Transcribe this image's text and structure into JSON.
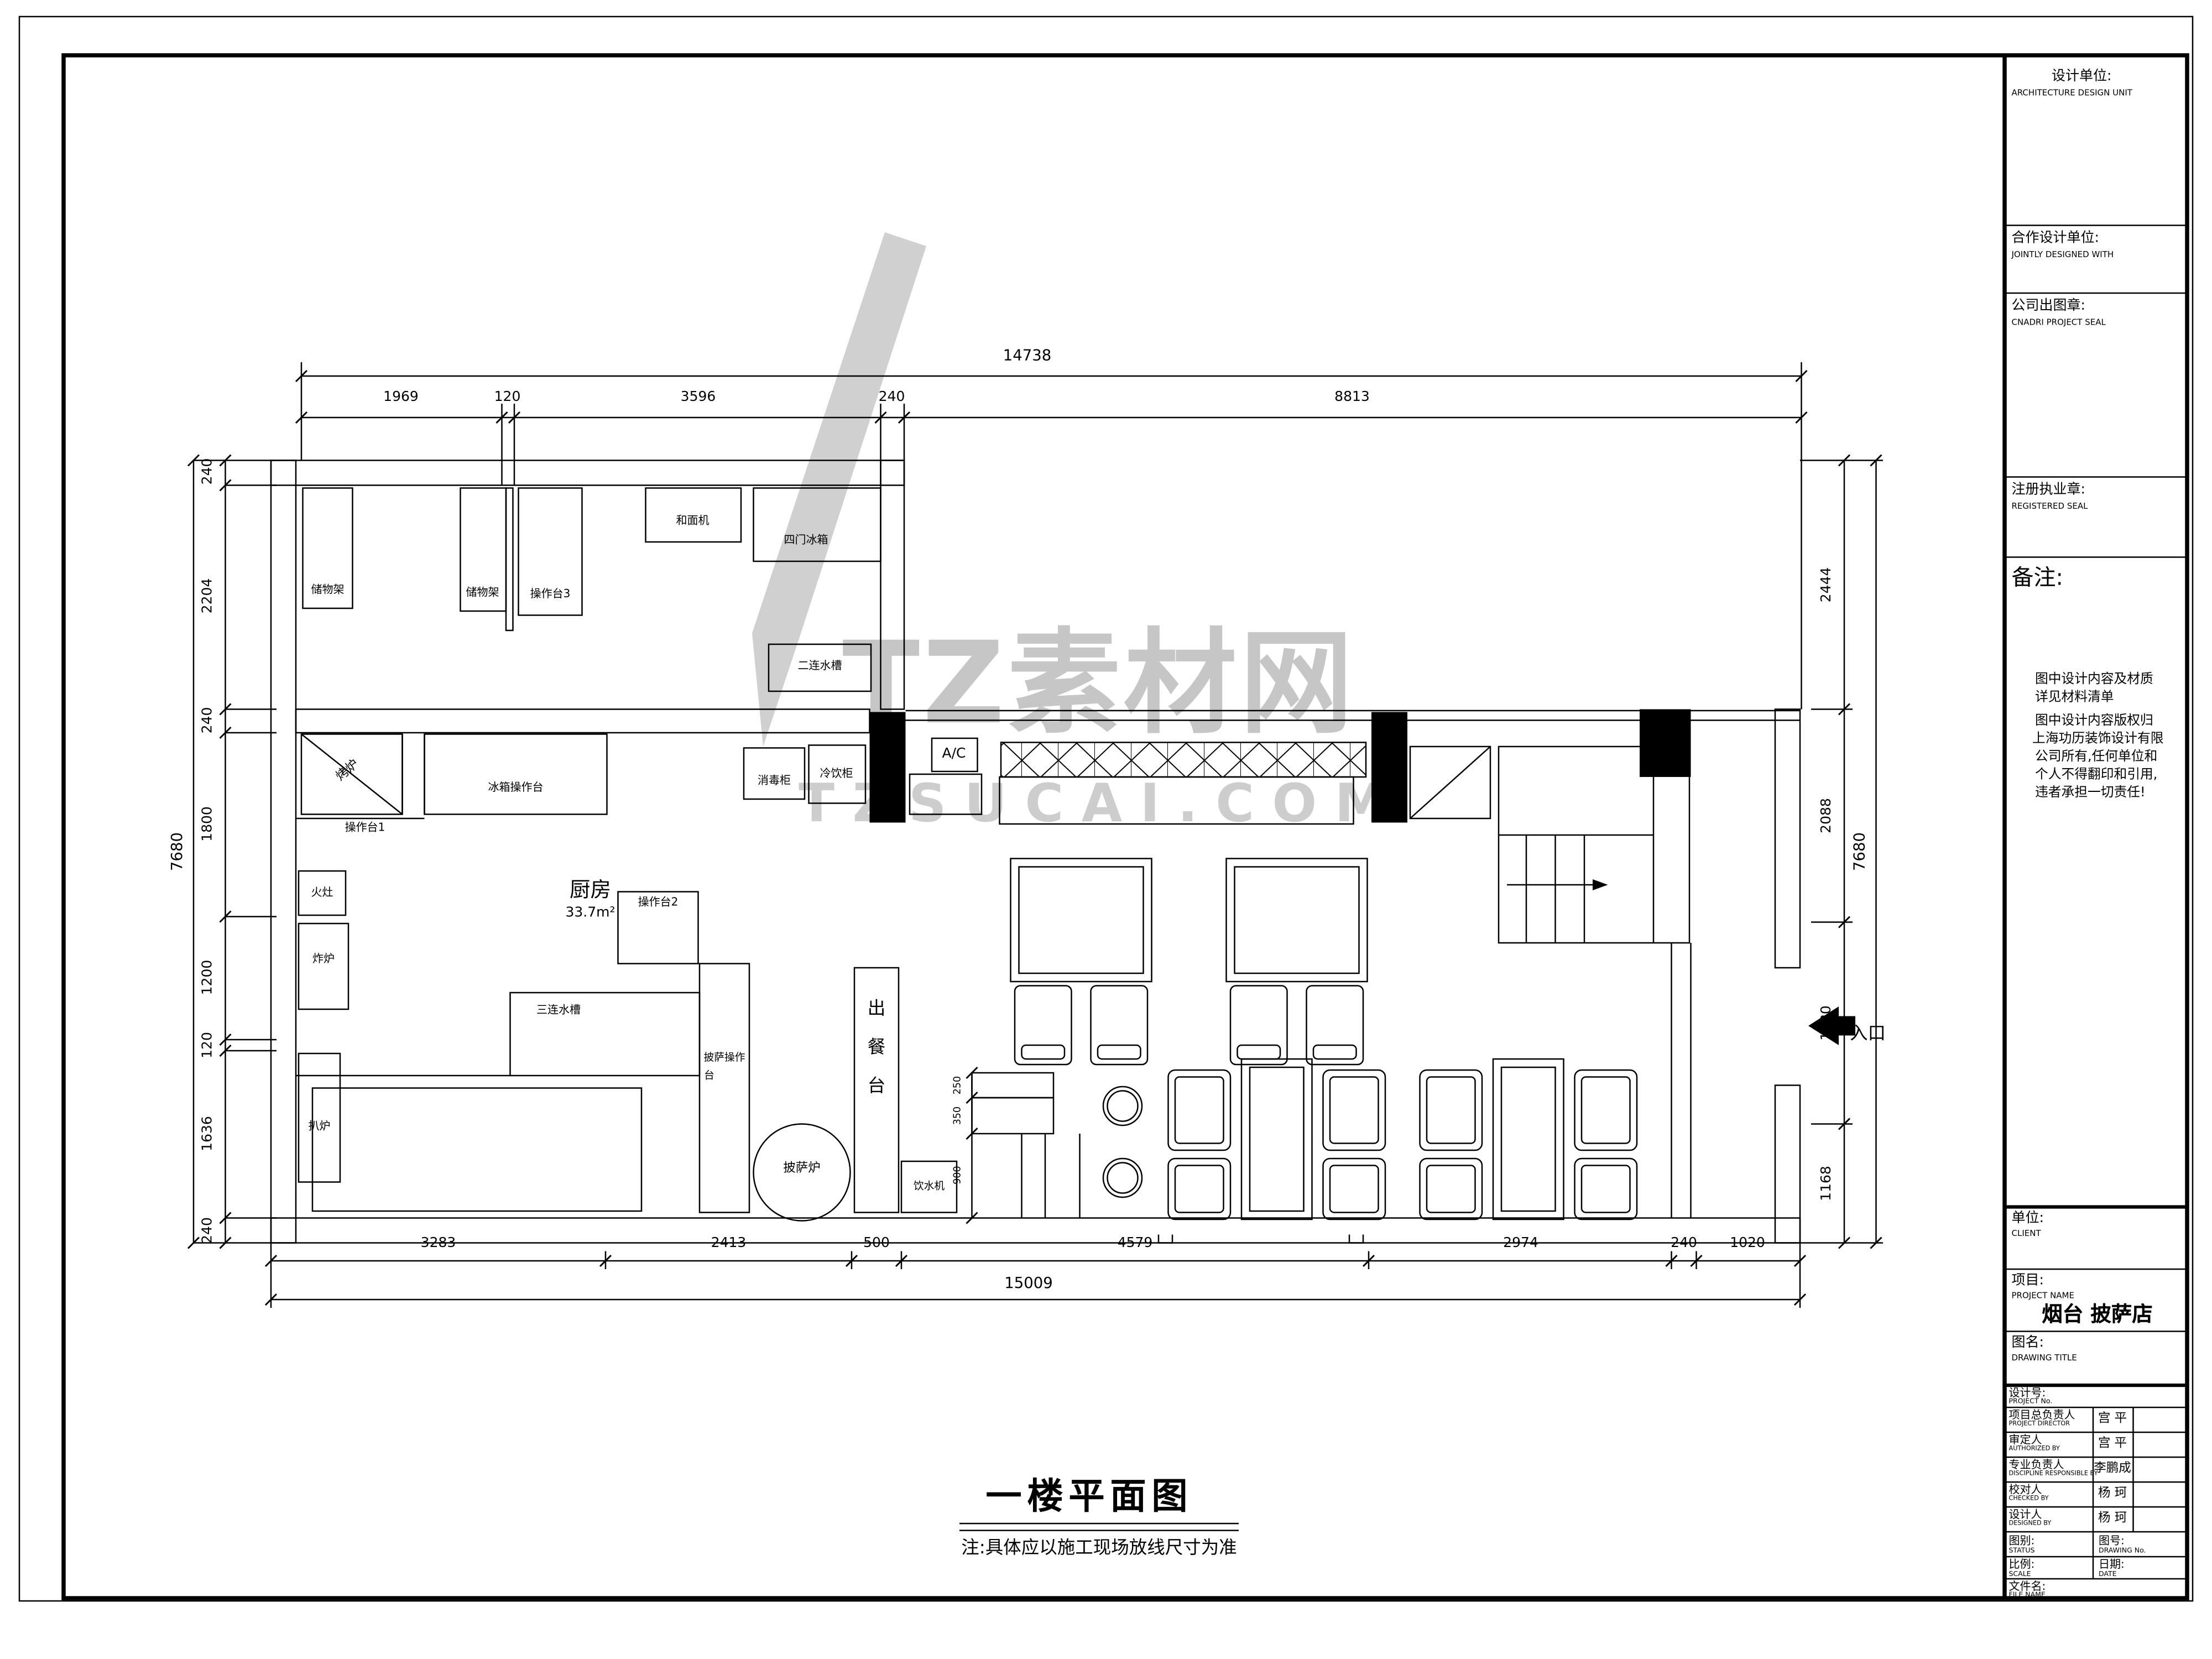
{
  "watermark": {
    "brand": "TZ素材网",
    "domain": "TZSUCAI.COM"
  },
  "dims": {
    "top": {
      "total": "14738",
      "segments": [
        "1969",
        "120",
        "3596",
        "240",
        "8813"
      ]
    },
    "bottom": {
      "total": "15009",
      "segments": [
        "3283",
        "2413",
        "500",
        "4579",
        "2974",
        "240",
        "1020"
      ]
    },
    "left": {
      "total": "7680",
      "segments": [
        "240",
        "2204",
        "240",
        "1800",
        "1200",
        "120",
        "1636",
        "240"
      ]
    },
    "right": {
      "total": "7680",
      "segments": [
        "2444",
        "2088",
        "1980",
        "1168"
      ]
    },
    "service_counter": [
      "250",
      "350",
      "900"
    ]
  },
  "plan": {
    "entrance": "入口",
    "room": {
      "name": "厨房",
      "area": "33.7m²"
    },
    "equipment": {
      "shelf1": "储物架",
      "shelf2": "储物架",
      "worktop3": "操作台3",
      "dough_mixer": "和面机",
      "four_door_fridge": "四门冰箱",
      "double_sink": "二连水槽",
      "oven": "烤炉",
      "fridge_counter": "冰箱操作台",
      "worktop1": "操作台1",
      "stove": "火灶",
      "fryer": "炸炉",
      "griddle": "扒炉",
      "triple_sink": "三连水槽",
      "worktop2": "操作台2",
      "pizza_counter_l1": "披萨操作",
      "pizza_counter_l2": "台",
      "pizza_oven": "披萨炉",
      "serving_1": "出",
      "serving_2": "餐",
      "serving_3": "台",
      "water_dispenser": "饮水机",
      "sterilizer": "消毒柜",
      "drink_cabinet": "冷饮柜",
      "ac": "A/C"
    }
  },
  "title_block": {
    "design_unit": {
      "cn": "设计单位:",
      "en": "ARCHITECTURE DESIGN UNIT"
    },
    "joint_design": {
      "cn": "合作设计单位:",
      "en": "JOINTLY DESIGNED WITH"
    },
    "company_seal": {
      "cn": "公司出图章:",
      "en": "CNADRI PROJECT SEAL"
    },
    "registered_seal": {
      "cn": "注册执业章:",
      "en": "REGISTERED SEAL"
    },
    "remarks": {
      "cn": "备注:",
      "lines": [
        "图中设计内容及材质",
        "详见材料清单",
        "图中设计内容版权归",
        "上海功历装饰设计有限",
        "公司所有,任何单位和",
        "个人不得翻印和引用,",
        "违者承担一切责任!"
      ]
    },
    "client": {
      "cn": "单位:",
      "en": "CLIENT"
    },
    "project": {
      "cn": "项目:",
      "en": "PROJECT NAME",
      "value": "烟台 披萨店"
    },
    "drawing_name": {
      "cn": "图名:",
      "en": "DRAWING TITLE"
    },
    "project_no": {
      "cn": "设计号:",
      "en": "PROJECT No."
    },
    "rows": [
      {
        "cn": "项目总负责人",
        "en": "PROJECT DIRECTOR",
        "value": "宫 平"
      },
      {
        "cn": "审定人",
        "en": "AUTHORIZED BY",
        "value": "宫 平"
      },
      {
        "cn": "专业负责人",
        "en": "DISCIPLINE RESPONSIBLE BY",
        "value": "李鹏成"
      },
      {
        "cn": "校对人",
        "en": "CHECKED BY",
        "value": "杨 珂"
      },
      {
        "cn": "设计人",
        "en": "DESIGNED BY",
        "value": "杨 珂"
      }
    ],
    "status": {
      "cn": "图别:",
      "en": "STATUS"
    },
    "drawing_no": {
      "cn": "图号:",
      "en": "DRAWING No."
    },
    "scale": {
      "cn": "比例:",
      "en": "SCALE"
    },
    "date": {
      "cn": "日期:",
      "en": "DATE"
    },
    "file_name": {
      "cn": "文件名:",
      "en": "FILE NAME"
    }
  },
  "footer": {
    "title": "一楼平面图",
    "note": "注:具体应以施工现场放线尺寸为准"
  }
}
